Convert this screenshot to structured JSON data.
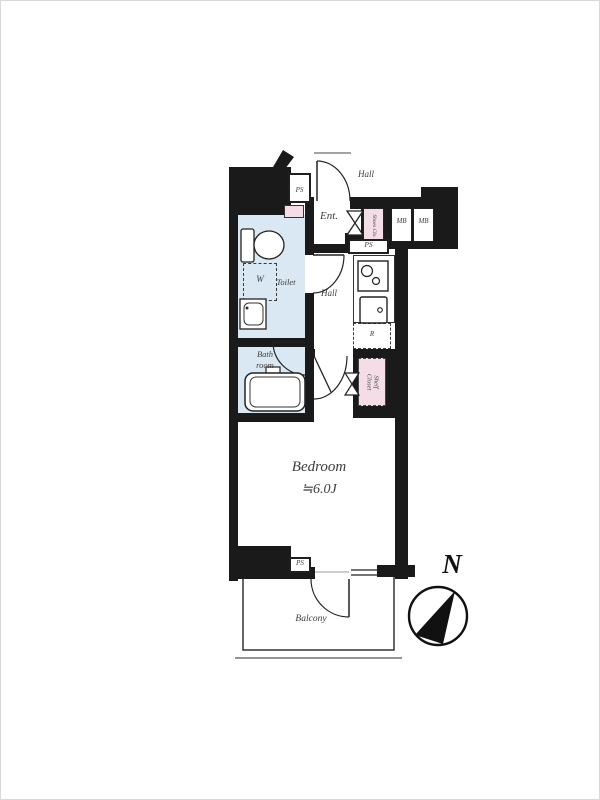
{
  "floorplan": {
    "rooms": {
      "upper_hall": "Hall",
      "entrance": "Ent.",
      "inner_hall": "Hall",
      "toilet": "Toilet",
      "bath_line1": "Bath",
      "bath_line2": "room",
      "bedroom_name": "Bedroom",
      "bedroom_size": "≒6.0J",
      "balcony": "Balcony"
    },
    "storage": {
      "shoes_closet": "Shoes Clo.",
      "shelf_closet_line1": "Shelf",
      "shelf_closet_line2": "Closet",
      "washer": "W",
      "refrigerator": "R"
    },
    "utility": {
      "ps_top": "PS",
      "ps_mid": "PS",
      "ps_bottom": "PS",
      "mb_1": "MB",
      "mb_2": "MB"
    },
    "compass_north": "N",
    "colors": {
      "wall": "#1a1a1a",
      "wet_room_fill": "#d9e8f2",
      "closet_fill": "#f4dde6",
      "label_text": "#3d3d3d"
    }
  }
}
